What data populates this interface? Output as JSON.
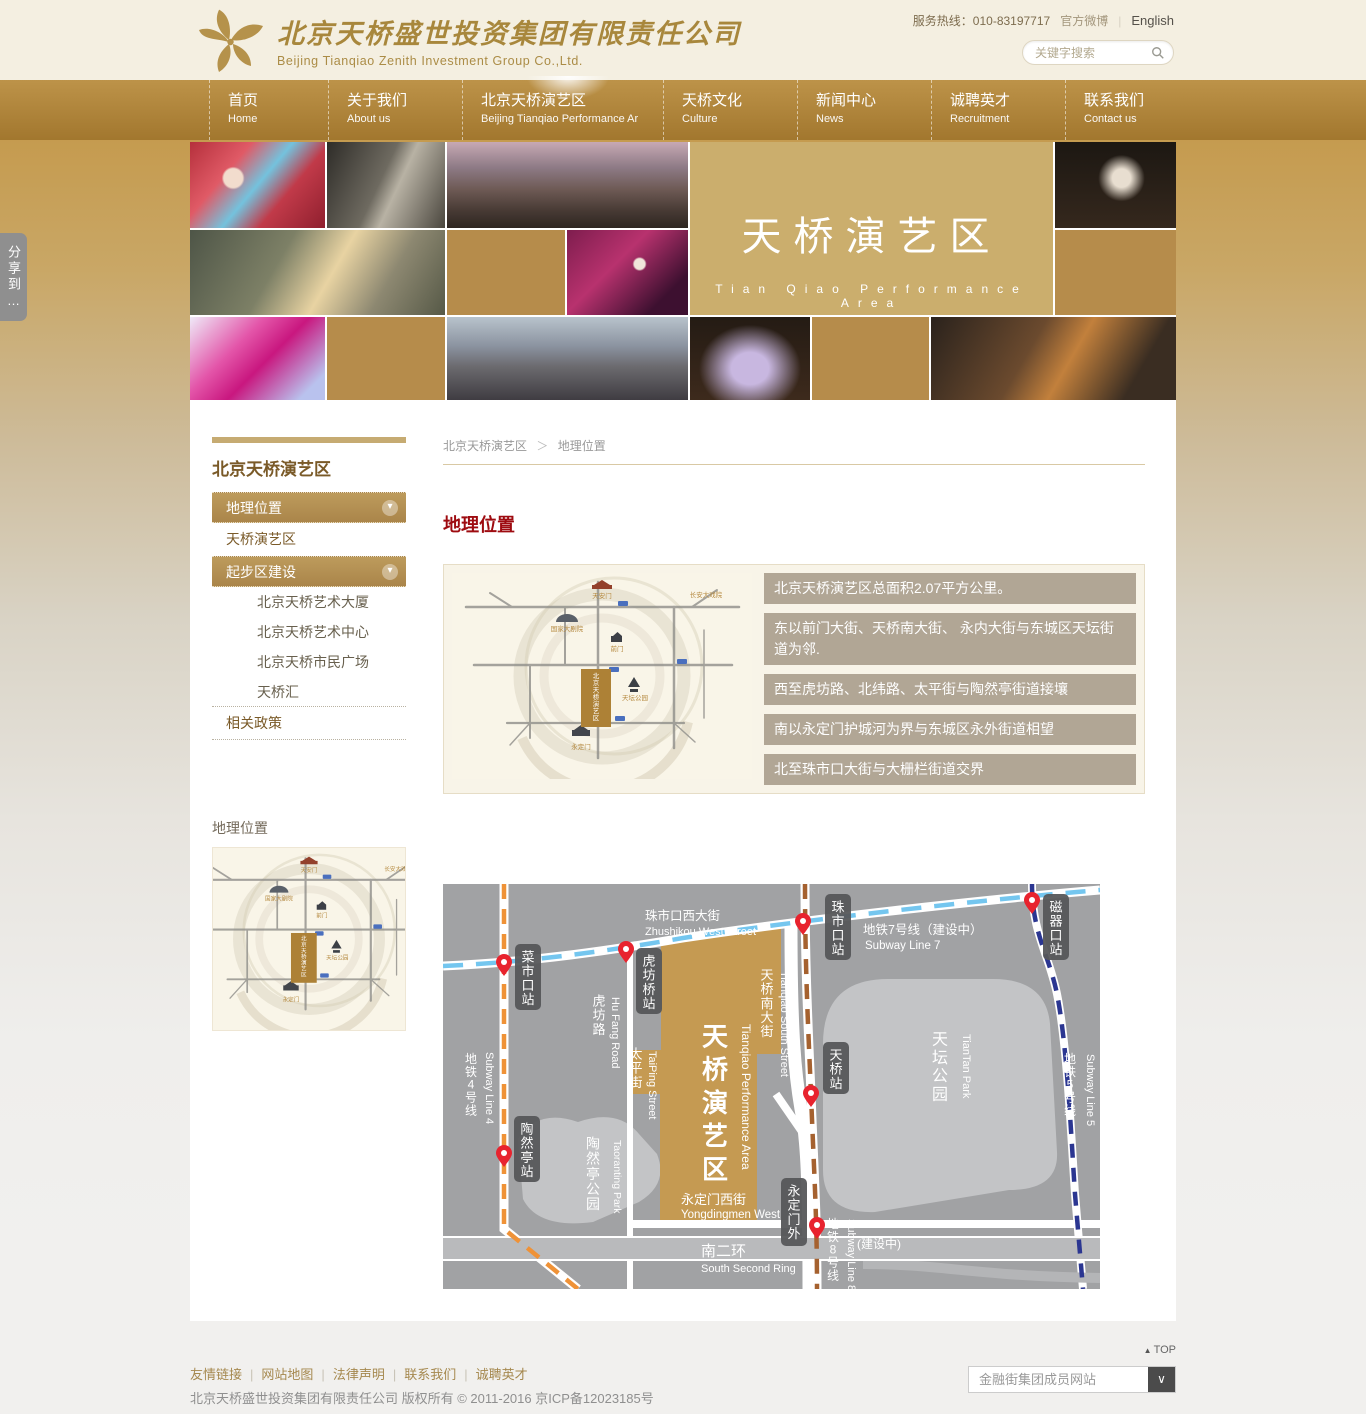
{
  "header": {
    "company_cn": "北京天桥盛世投资集团有限责任公司",
    "company_en": "Beijing Tianqiao Zenith Investment Group Co.,Ltd.",
    "hotline": "服务热线：010-83197717",
    "weibo": "官方微博",
    "lang": "English",
    "search_placeholder": "关键字搜索"
  },
  "nav": {
    "items": [
      {
        "cn": "首页",
        "en": "Home"
      },
      {
        "cn": "关于我们",
        "en": "About us"
      },
      {
        "cn": "北京天桥演艺区",
        "en": "Beijing Tianqiao Performance Ar"
      },
      {
        "cn": "天桥文化",
        "en": "Culture"
      },
      {
        "cn": "新闻中心",
        "en": "News"
      },
      {
        "cn": "诚聘英才",
        "en": "Recruitment"
      },
      {
        "cn": "联系我们",
        "en": "Contact us"
      }
    ]
  },
  "share_label": "分享到…",
  "banner": {
    "title_cn": "天桥演艺区",
    "title_en": "Tian Qiao Performance Area"
  },
  "sidebar": {
    "title": "北京天桥演艺区",
    "items": [
      {
        "label": "地理位置"
      },
      {
        "label": "天桥演艺区"
      },
      {
        "label": "起步区建设"
      },
      {
        "label": "北京天桥艺术大厦"
      },
      {
        "label": "北京天桥艺术中心"
      },
      {
        "label": "北京天桥市民广场"
      },
      {
        "label": "天桥汇"
      },
      {
        "label": "相关政策"
      }
    ],
    "arrow": "▾",
    "caption": "地理位置"
  },
  "breadcrumb": {
    "parent": "北京天桥演艺区",
    "sep": "＞",
    "current": "地理位置"
  },
  "content": {
    "heading": "地理位置",
    "facts": [
      "北京天桥演艺区总面积2.07平方公里。",
      "东以前门大街、天桥南大街、 永内大街与东城区天坛街道为邻.",
      "西至虎坊路、北纬路、太平街与陶然亭街道接壤",
      "南以永定门护城河为界与东城区永外街道相望",
      "北至珠市口大街与大栅栏街道交界"
    ]
  },
  "art_map": {
    "center_label": "北京天桥演艺区",
    "landmarks": {
      "tiananmen": "天安门",
      "changan_theatre": "长安大戏院",
      "ncpa": "国家大剧院",
      "qianmen": "前门",
      "tiantan": "天坛公园",
      "yongdingmen": "永定门"
    }
  },
  "map": {
    "areas": {
      "performance": {
        "cn": "天桥演艺区",
        "en": "Tianqiao Performance Area"
      },
      "tiantan": {
        "cn": "天坛公园",
        "en": "TianTan Park"
      },
      "taoranting": {
        "cn": "陶然亭公园",
        "en": "Taoranting Park"
      }
    },
    "streets": {
      "zhushikou": {
        "cn": "珠市口西大街",
        "en": "Zhushikou West Street"
      },
      "hufang": {
        "cn": "虎坊路",
        "en": "Hu Fang Road"
      },
      "taiping": {
        "cn": "太平街",
        "en": "TaiPing Street"
      },
      "tianqiao_south": {
        "cn": "天桥南大街",
        "en": "Tianqiao South Street"
      },
      "yongdingmen_west": {
        "cn": "永定门西街",
        "en": "Yongdingmen West"
      },
      "south_second_ring": {
        "cn": "南二环",
        "en": "South Second Ring"
      }
    },
    "subway": {
      "line4": {
        "cn": "地铁4号线",
        "en": "Subway Line 4"
      },
      "line5": {
        "cn": "地铁5号线",
        "en": "Subway Line 5"
      },
      "line7": {
        "cn": "地铁7号线（建设中）",
        "en": "Subway Line 7"
      },
      "line8": {
        "cn": "地铁8号线",
        "en": "Subway Line 8",
        "note": "(建设中)"
      }
    },
    "stations": {
      "caishikou": "菜市口站",
      "hufangqiao": "虎坊桥站",
      "zhushikou": "珠市口站",
      "ciqikou": "磁器口站",
      "tianqiao": "天桥站",
      "taoranting": "陶然亭站",
      "yongdingmenwai": "永定门外"
    },
    "colors": {
      "line4": "#ef9237",
      "line5": "#2b3691",
      "line7": "#74c6ef",
      "line8": "#a5612f",
      "zone_gold": "#c59a52",
      "map_bg": "#a1a2a4",
      "park": "#c3c4c6",
      "pin_red": "#e8232e"
    }
  },
  "footer": {
    "top": "TOP",
    "links": [
      "友情链接",
      "网站地图",
      "法律声明",
      "联系我们",
      "诚聘英才"
    ],
    "copyright": "北京天桥盛世投资集团有限责任公司 版权所有 © 2011-2016 京ICP备12023185号",
    "dropdown_label": "金融街集团成员网站"
  }
}
